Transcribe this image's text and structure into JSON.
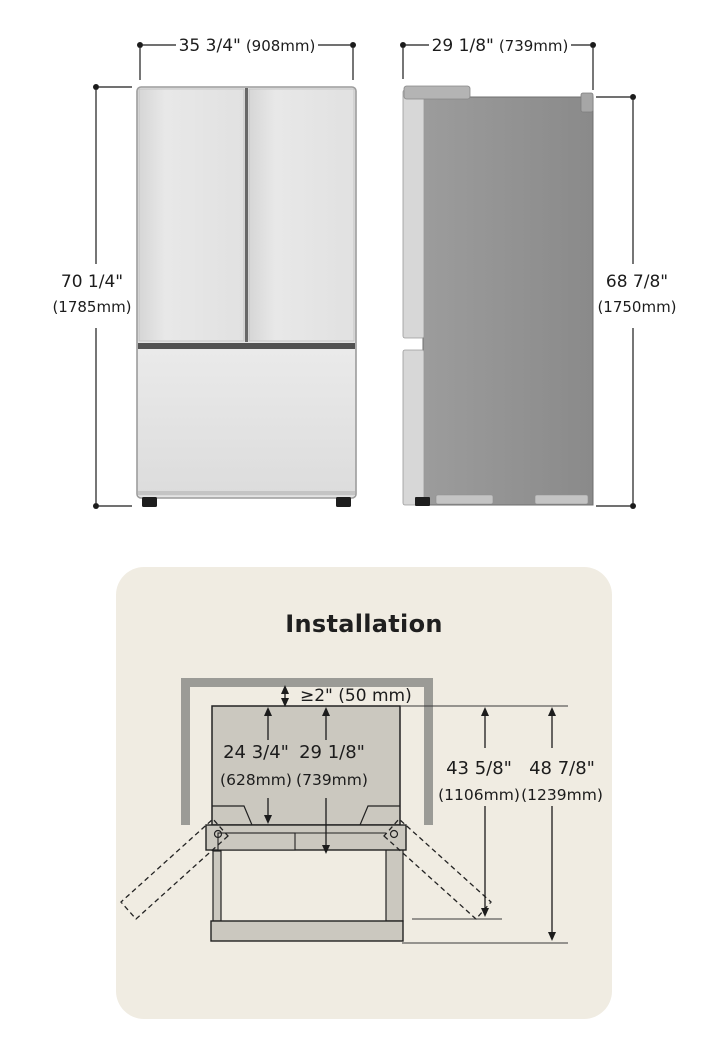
{
  "front_view": {
    "width": {
      "inches": "35 3/4\"",
      "mm": "(908mm)"
    },
    "height": {
      "inches": "70 1/4\"",
      "mm": "(1785mm)"
    }
  },
  "side_view": {
    "depth": {
      "inches": "29 1/8\"",
      "mm": "(739mm)"
    },
    "height": {
      "inches": "68 7/8\"",
      "mm": "(1750mm)"
    }
  },
  "installation": {
    "title": "Installation",
    "top_clearance": "≥2\" (50 mm)",
    "dims": [
      {
        "inches": "24 3/4\"",
        "mm": "(628mm)"
      },
      {
        "inches": "29 1/8\"",
        "mm": "(739mm)"
      },
      {
        "inches": "43 5/8\"",
        "mm": "(1106mm)"
      },
      {
        "inches": "48 7/8\"",
        "mm": "(1239mm)"
      }
    ]
  },
  "colors": {
    "card_background": "#f0ece2",
    "drawing_fill": "#cbc8bf",
    "wall_gray": "#9b9b96",
    "fridge_front": "#e4e4e4",
    "fridge_side": "#909090",
    "line": "#1c1c1c"
  }
}
